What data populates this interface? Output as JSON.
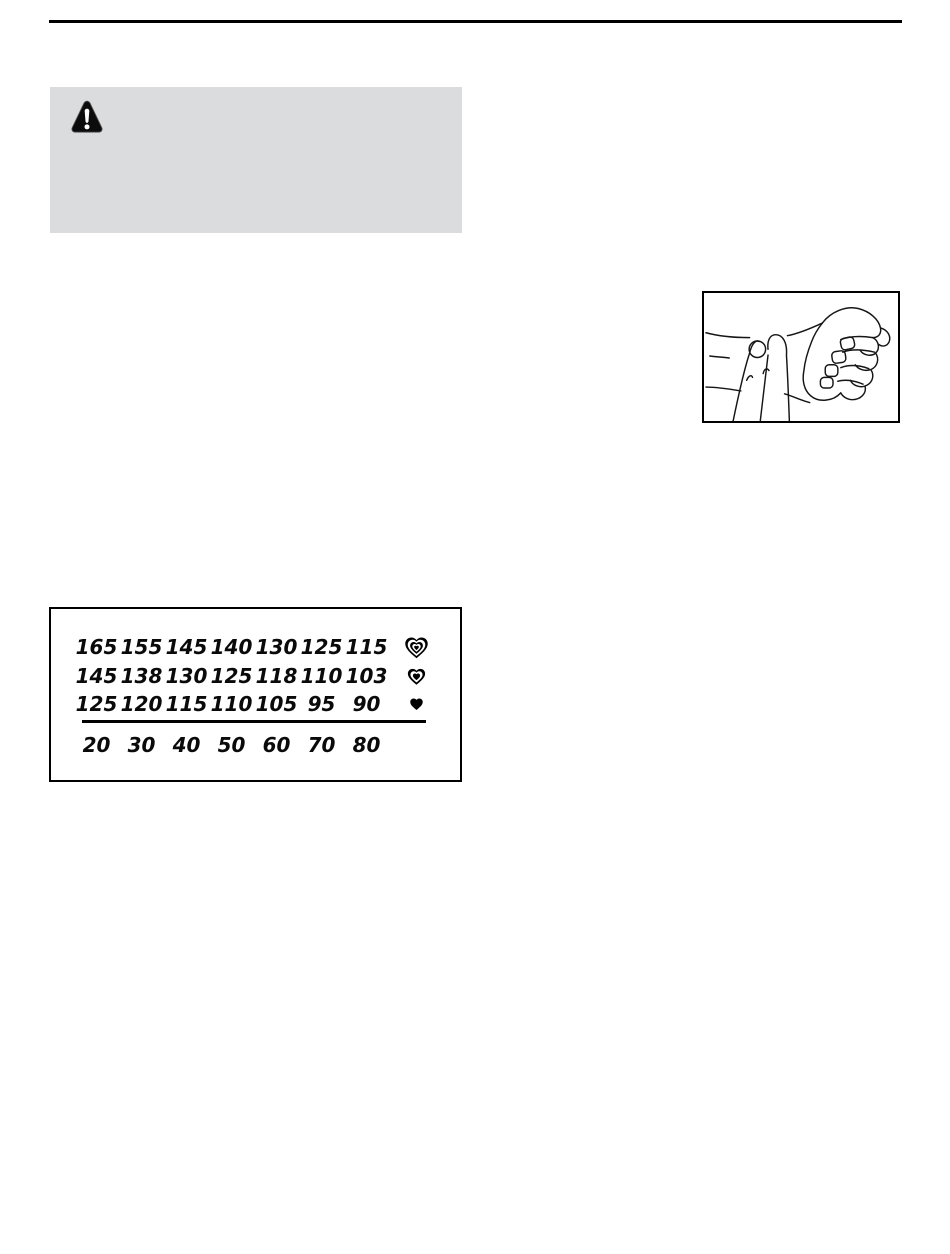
{
  "page": {
    "background": "#ffffff",
    "rule_color": "#000000"
  },
  "warning_box": {
    "background": "#dbdcde",
    "icon": "warning-triangle-icon"
  },
  "pulse_figure": {
    "icon": "fingers-on-wrist-illustration"
  },
  "heart_rate_table": {
    "border_color": "#000000",
    "rows": [
      {
        "icon": "heart-triple-icon",
        "values": [
          "165",
          "155",
          "145",
          "140",
          "130",
          "125",
          "115"
        ]
      },
      {
        "icon": "heart-double-icon",
        "values": [
          "145",
          "138",
          "130",
          "125",
          "118",
          "110",
          "103"
        ]
      },
      {
        "icon": "heart-solid-icon",
        "values": [
          "125",
          "120",
          "115",
          "110",
          "105",
          "95",
          "90"
        ]
      }
    ],
    "age_row": [
      "20",
      "30",
      "40",
      "50",
      "60",
      "70",
      "80"
    ]
  }
}
